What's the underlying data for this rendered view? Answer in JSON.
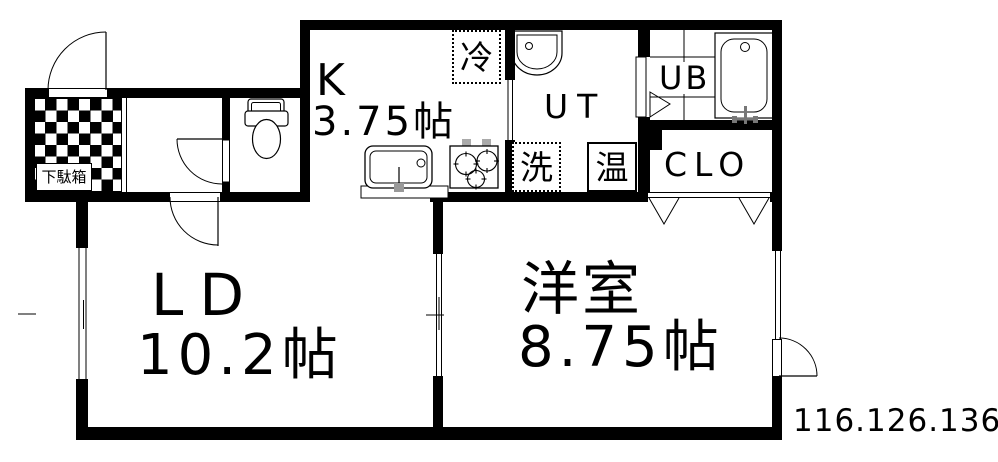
{
  "watermark": "116.126.136",
  "rooms": {
    "kitchen": {
      "label": "K",
      "area": "3.75帖"
    },
    "living_dining": {
      "label": "LD",
      "area": "10.2帖"
    },
    "western_room": {
      "label": "洋室",
      "area": "8.75帖"
    },
    "utility": {
      "label": "UT"
    },
    "unit_bath": {
      "label": "UB"
    },
    "closet": {
      "label": "CLO"
    }
  },
  "fixtures": {
    "shoe_cabinet": "下駄箱",
    "refrigerator": "冷",
    "washing_machine": "洗",
    "water_heater": "温"
  }
}
